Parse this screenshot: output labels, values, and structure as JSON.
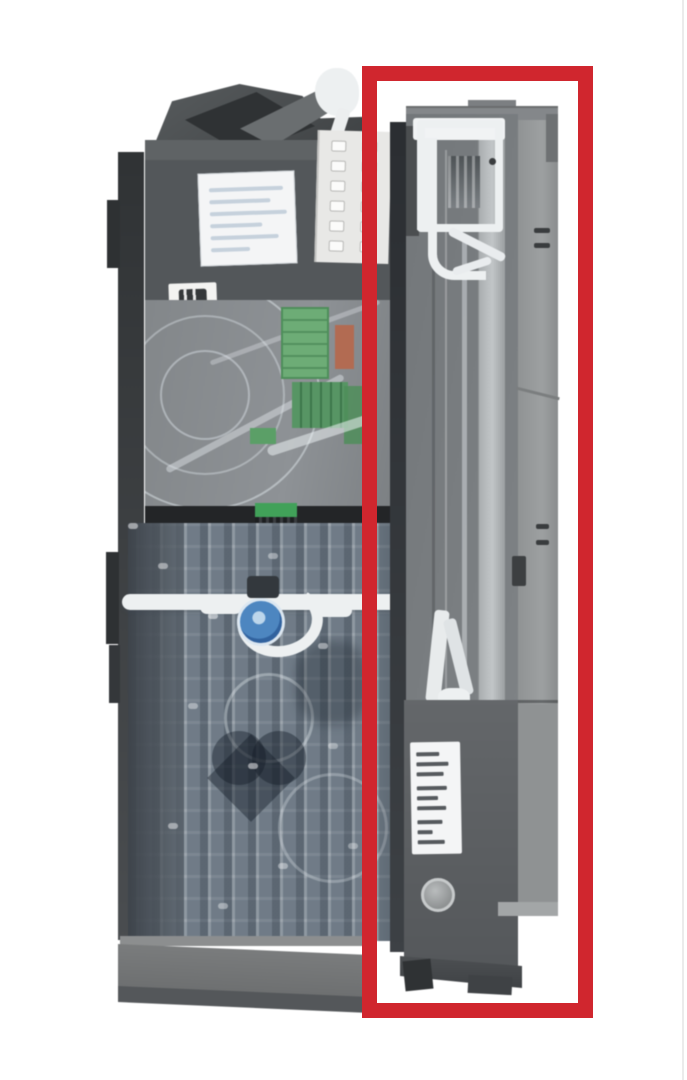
{
  "photo": {
    "background": "#ffffff",
    "subject": "coin-changer-unit-with-right-module-highlighted"
  },
  "highlight_box": {
    "color": "#d0262e",
    "shape": "rectangle-outline"
  },
  "colors": {
    "page-bg": "#ffffff",
    "photo-line": "#ebebeb",
    "red": "#d0262e",
    "housing-dark": "#3c3f41",
    "housing": "#53575a",
    "white-part": "#edf0f1",
    "label-white": "#f4f5f6",
    "scribble-blue": "#9fb3c8",
    "spec-text": "#565a5e",
    "keypad-panel": "#e8e8e6",
    "keypad-button": "#fbfbfa",
    "pcb-green": "#6bad74",
    "pcb-green-dark": "#4c8f58",
    "connector-green": "#3da257",
    "component-orange": "#b56a50",
    "band-black": "#232527",
    "tube-base": "#76828e",
    "knob-blue": "#4a86c4",
    "knob-blue-dark": "#2f62a2",
    "knob-ring": "#bcd6ec",
    "base-gray": "#7a7c7d",
    "base-dark": "#54575a",
    "module-front": "#73777a",
    "module-side": "#909394",
    "module-lower": "#64676a",
    "gap-dark": "#3d4145",
    "bright-strip": "#c2c6c8"
  },
  "keypad": {
    "columns": 2,
    "rows": 6
  },
  "handwritten_label": {
    "line_count": 6,
    "legible": false
  },
  "spec_label": {
    "line_count": 9,
    "legible": false
  }
}
